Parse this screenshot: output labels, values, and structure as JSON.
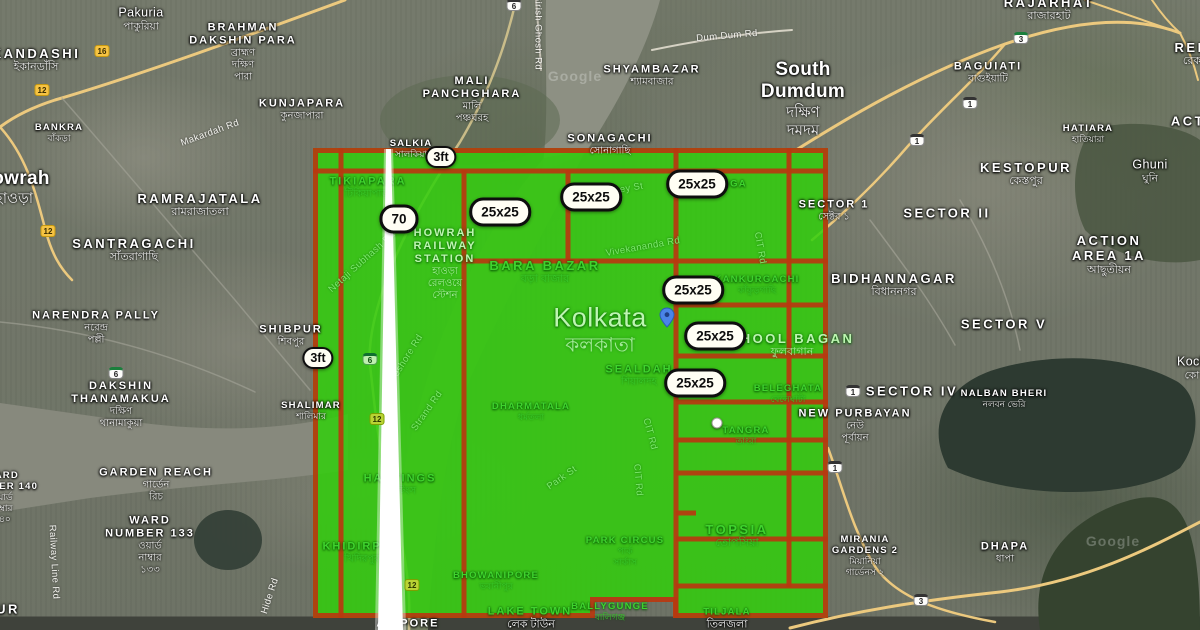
{
  "colors": {
    "overlay_green": "#31cf0c",
    "grid_red": "#b8380f",
    "badge_background": "#fffef4",
    "badge_border": "#0e0e0e",
    "pin_blue": "#4a84e8"
  },
  "overlay": {
    "badges": [
      {
        "t": "3ft",
        "x": 441,
        "y": 157,
        "small": true
      },
      {
        "t": "70",
        "x": 399,
        "y": 219,
        "small": false
      },
      {
        "t": "25x25",
        "x": 500,
        "y": 212,
        "small": false
      },
      {
        "t": "25x25",
        "x": 591,
        "y": 197,
        "small": false
      },
      {
        "t": "25x25",
        "x": 697,
        "y": 184,
        "small": false
      },
      {
        "t": "25x25",
        "x": 693,
        "y": 290,
        "small": false
      },
      {
        "t": "25x25",
        "x": 715,
        "y": 336,
        "small": false
      },
      {
        "t": "25x25",
        "x": 695,
        "y": 383,
        "small": false
      },
      {
        "t": "3ft",
        "x": 318,
        "y": 358,
        "small": true
      }
    ]
  },
  "markers": {
    "pin": {
      "x": 667,
      "y": 317
    },
    "dot": {
      "x": 717,
      "y": 423
    }
  },
  "place_labels": [
    {
      "t": "Pakuria",
      "bn": "পাকুরিয়া",
      "x": 141,
      "y": 19,
      "cls": "town",
      "tint": "w"
    },
    {
      "t": "BRAHMAN\nDAKSHIN PARA",
      "bn": "ব্রাহ্মণ\nদক্ষিণ\nপারা",
      "x": 243,
      "y": 52,
      "cls": "area",
      "tint": "w"
    },
    {
      "t": "KANDASHI",
      "bn": "ইকানডাঁসি",
      "x": 36,
      "y": 60,
      "cls": "area-lg",
      "tint": "w"
    },
    {
      "t": "KUNJAPARA",
      "bn": "কুনজাপারা",
      "x": 302,
      "y": 110,
      "cls": "area",
      "tint": "w"
    },
    {
      "t": "BANKRA",
      "bn": "বাঁকড়া",
      "x": 59,
      "y": 133,
      "cls": "area-sm",
      "tint": "w"
    },
    {
      "t": "Howrah",
      "bn": "হাওড়া",
      "x": 14,
      "y": 188,
      "cls": "city",
      "tint": "w"
    },
    {
      "t": "RAMRAJATALA",
      "bn": "রামরাজাতলা",
      "x": 200,
      "y": 205,
      "cls": "area-lg",
      "tint": "w"
    },
    {
      "t": "SANTRAGACHI",
      "bn": "সাঁতরাগাছি",
      "x": 134,
      "y": 250,
      "cls": "area-lg",
      "tint": "w"
    },
    {
      "t": "NARENDRA PALLY",
      "bn": "নরেন্দ্র\nপল্লী",
      "x": 96,
      "y": 328,
      "cls": "area",
      "tint": "w"
    },
    {
      "t": "SHIBPUR",
      "bn": "শিবপুর",
      "x": 291,
      "y": 336,
      "cls": "area",
      "tint": "w"
    },
    {
      "t": "DAKSHIN\nTHANAMAKUA",
      "bn": "দক্ষিণ\nথানামাকুয়া",
      "x": 121,
      "y": 405,
      "cls": "area",
      "tint": "w"
    },
    {
      "t": "SHALIMAR",
      "bn": "শালিমার",
      "x": 311,
      "y": 411,
      "cls": "area-sm",
      "tint": "w"
    },
    {
      "t": "GARDEN REACH",
      "bn": "গার্ডেন\nরিচ",
      "x": 156,
      "y": 485,
      "cls": "area",
      "tint": "w"
    },
    {
      "t": "WARD\nNUMBER 140",
      "bn": "ওয়ার্ড\nনাম্বার\n১৪০",
      "x": 2,
      "y": 497,
      "cls": "area-sm",
      "tint": "w"
    },
    {
      "t": "WARD\nNUMBER 133",
      "bn": "ওয়ার্ড\nনাম্বার\n১৩৩",
      "x": 150,
      "y": 545,
      "cls": "area",
      "tint": "w"
    },
    {
      "t": "UR",
      "x": 8,
      "y": 609,
      "cls": "area-lg",
      "tint": "w"
    },
    {
      "t": "MALI\nPANCHGHARA",
      "bn": "মালি\nপঞ্চঘরহ",
      "x": 472,
      "y": 100,
      "cls": "area",
      "tint": "w"
    },
    {
      "t": "SHYAMBAZAR",
      "bn": "শ্যামবাজার",
      "x": 652,
      "y": 76,
      "cls": "area",
      "tint": "w"
    },
    {
      "t": "South\nDumdum",
      "bn": "দক্ষিণ\nদমদম",
      "x": 803,
      "y": 99,
      "cls": "city",
      "tint": "w"
    },
    {
      "t": "SONAGACHI",
      "bn": "সোনাগাছি",
      "x": 610,
      "y": 145,
      "cls": "area",
      "tint": "w"
    },
    {
      "t": "SALKIA",
      "bn": "সালকিয়া",
      "x": 411,
      "y": 149,
      "cls": "area-sm",
      "tint": "w"
    },
    {
      "t": "RAJARHAT",
      "bn": "রাজারহাট",
      "x": 1049,
      "y": 9,
      "cls": "area-lg",
      "tint": "w"
    },
    {
      "t": "BAGUIATI",
      "bn": "বাগুইয়াটি",
      "x": 988,
      "y": 73,
      "cls": "area",
      "tint": "w"
    },
    {
      "t": "KESTOPUR",
      "bn": "কেস্তপুর",
      "x": 1026,
      "y": 174,
      "cls": "area-lg",
      "tint": "w"
    },
    {
      "t": "HATIARA",
      "bn": "হাতিয়ারা",
      "x": 1088,
      "y": 134,
      "cls": "area-sm",
      "tint": "w"
    },
    {
      "t": "Ghuni",
      "bn": "ঘুনি",
      "x": 1150,
      "y": 171,
      "cls": "town",
      "tint": "w"
    },
    {
      "t": "REK",
      "bn": "রেক",
      "x": 1192,
      "y": 54,
      "cls": "area-lg",
      "tint": "w"
    },
    {
      "t": "ACT",
      "x": 1188,
      "y": 121,
      "cls": "area-lg",
      "tint": "w"
    },
    {
      "t": "SECTOR 1",
      "bn": "সেক্টর ১",
      "x": 834,
      "y": 211,
      "cls": "area",
      "tint": "w"
    },
    {
      "t": "SECTOR II",
      "x": 947,
      "y": 213,
      "cls": "area-lg",
      "tint": "w"
    },
    {
      "t": "ACTION\nAREA 1A",
      "bn": "আছুতীয়ন",
      "x": 1109,
      "y": 255,
      "cls": "area-lg",
      "tint": "w"
    },
    {
      "t": "BIDHANNAGAR",
      "bn": "বিধাননগর",
      "x": 894,
      "y": 285,
      "cls": "area-lg",
      "tint": "w"
    },
    {
      "t": "SECTOR V",
      "x": 1004,
      "y": 324,
      "cls": "area-lg",
      "tint": "w"
    },
    {
      "t": "SECTOR IV",
      "x": 912,
      "y": 391,
      "cls": "area-lg",
      "tint": "w"
    },
    {
      "t": "NALBAN BHERI",
      "bn": "নলবন ভেরি",
      "x": 1004,
      "y": 399,
      "cls": "area-sm",
      "tint": "w"
    },
    {
      "t": "NEW PURBAYAN",
      "bn": "নেউ\nপূর্বায়ন",
      "x": 855,
      "y": 426,
      "cls": "area",
      "tint": "w"
    },
    {
      "t": "Koch",
      "bn": "কো",
      "x": 1192,
      "y": 368,
      "cls": "town",
      "tint": "w"
    },
    {
      "t": "MIRANIA\nGARDENS 2",
      "bn": "মিয়ানিয়া\nগার্ডেনস ২",
      "x": 865,
      "y": 556,
      "cls": "area-sm",
      "tint": "w"
    },
    {
      "t": "DHAPA",
      "bn": "ধাপা",
      "x": 1005,
      "y": 553,
      "cls": "area",
      "tint": "w"
    },
    {
      "t": "ALIPORE",
      "x": 408,
      "y": 624,
      "cls": "area",
      "tint": "w"
    },
    {
      "t": "লেক টাউন",
      "x": 531,
      "y": 625,
      "cls": "bn-only",
      "tint": "w"
    },
    {
      "t": "তিলজলা",
      "x": 727,
      "y": 625,
      "cls": "bn-only",
      "tint": "w"
    },
    {
      "t": "TIKIAPARA",
      "bn": "টিকিয়াপাড়া",
      "x": 368,
      "y": 188,
      "cls": "area",
      "tint": "g"
    },
    {
      "t": "HOWRAH\nRAILWAY\nSTATION",
      "bn": "হাওড়া\nরেলওয়ে\nস্টেশন",
      "x": 445,
      "y": 264,
      "cls": "area",
      "tint": "gb"
    },
    {
      "t": "BARA BAZAR",
      "bn": "বড়া বাজার",
      "x": 545,
      "y": 272,
      "cls": "area-lg",
      "tint": "g"
    },
    {
      "t": "Kolkata",
      "bn": "কলকাতা",
      "x": 600,
      "y": 330,
      "cls": "city-xl",
      "tint": "gb"
    },
    {
      "t": "KANKURGACHI",
      "bn": "কাঁকুড়গাছি",
      "x": 757,
      "y": 285,
      "cls": "area-sm",
      "tint": "g"
    },
    {
      "t": "ULTADANGA",
      "x": 712,
      "y": 184,
      "cls": "area-sm",
      "tint": "g"
    },
    {
      "t": "PHOOL BAGAN",
      "bn": "ফুলবাগান",
      "x": 792,
      "y": 345,
      "cls": "area-lg",
      "tint": "gb"
    },
    {
      "t": "SEALDAH",
      "bn": "শিয়ালদহ",
      "x": 639,
      "y": 376,
      "cls": "area",
      "tint": "g"
    },
    {
      "t": "BELEGHATA",
      "bn": "বেলেঘাটা",
      "x": 788,
      "y": 394,
      "cls": "area-sm",
      "tint": "g"
    },
    {
      "t": "TANGRA",
      "bn": "তাংরা",
      "x": 746,
      "y": 436,
      "cls": "area-sm",
      "tint": "g"
    },
    {
      "t": "DHARMATALA",
      "bn": "ধর্মতলা",
      "x": 531,
      "y": 412,
      "cls": "area-sm",
      "tint": "g"
    },
    {
      "t": "HASTINGS",
      "bn": "হেস্টিংস",
      "x": 400,
      "y": 485,
      "cls": "area",
      "tint": "g"
    },
    {
      "t": "KHIDIRPUR",
      "bn": "খিদিরপুর",
      "x": 362,
      "y": 553,
      "cls": "area",
      "tint": "g"
    },
    {
      "t": "PARK CIRCUS",
      "bn": "পার্ক\nসার্কাস",
      "x": 625,
      "y": 551,
      "cls": "area-sm",
      "tint": "g"
    },
    {
      "t": "TOPSIA",
      "bn": "তোপসিয়া",
      "x": 737,
      "y": 536,
      "cls": "area-lg",
      "tint": "g"
    },
    {
      "t": "BHOWANIPORE",
      "bn": "ভবানীপুর",
      "x": 496,
      "y": 581,
      "cls": "area-sm",
      "tint": "g"
    },
    {
      "t": "BALLYGUNGE",
      "bn": "বালিগঞ্জ",
      "x": 610,
      "y": 612,
      "cls": "area-sm",
      "tint": "g"
    },
    {
      "t": "LAKE TOWN",
      "x": 530,
      "y": 612,
      "cls": "area",
      "tint": "g"
    },
    {
      "t": "TILJALA",
      "x": 727,
      "y": 612,
      "cls": "area-sm",
      "tint": "g"
    }
  ],
  "road_labels": [
    {
      "t": "Makardah Rd",
      "x": 210,
      "y": 133,
      "rot": -20,
      "tint": "w"
    },
    {
      "t": "Dum Dum Rd",
      "x": 727,
      "y": 36,
      "rot": -5,
      "tint": "w"
    },
    {
      "t": "Girish Ghosh Rd",
      "x": 538,
      "y": 32,
      "rot": 90,
      "tint": "w"
    },
    {
      "t": "Grey St",
      "x": 626,
      "y": 189,
      "rot": -10,
      "tint": "g"
    },
    {
      "t": "Vivekananda Rd",
      "x": 643,
      "y": 247,
      "rot": -10,
      "tint": "g"
    },
    {
      "t": "Netaji Subhash Rd",
      "x": 362,
      "y": 262,
      "rot": -42,
      "tint": "g"
    },
    {
      "t": "Foreshore Rd",
      "x": 404,
      "y": 362,
      "rot": -58,
      "tint": "g"
    },
    {
      "t": "Strand Rd",
      "x": 427,
      "y": 411,
      "rot": -55,
      "tint": "g"
    },
    {
      "t": "Park St",
      "x": 562,
      "y": 478,
      "rot": -35,
      "tint": "g"
    },
    {
      "t": "CIT Rd",
      "x": 760,
      "y": 248,
      "rot": 80,
      "tint": "g"
    },
    {
      "t": "CIT Rd",
      "x": 650,
      "y": 434,
      "rot": 75,
      "tint": "g"
    },
    {
      "t": "CIT Rd",
      "x": 638,
      "y": 480,
      "rot": 85,
      "tint": "g"
    },
    {
      "t": "Railway Line Rd",
      "x": 54,
      "y": 562,
      "rot": 87,
      "tint": "w"
    },
    {
      "t": "Hide Rd",
      "x": 270,
      "y": 596,
      "rot": -72,
      "tint": "w"
    }
  ],
  "shields": [
    {
      "n": "16",
      "x": 102,
      "y": 51,
      "kind": "yellow",
      "tint": false
    },
    {
      "n": "12",
      "x": 42,
      "y": 90,
      "kind": "yellow",
      "tint": false
    },
    {
      "n": "12",
      "x": 48,
      "y": 231,
      "kind": "yellow",
      "tint": false
    },
    {
      "n": "6",
      "x": 514,
      "y": 5,
      "kind": "nh",
      "tint": false
    },
    {
      "n": "6",
      "x": 116,
      "y": 373,
      "kind": "sh",
      "tint": false
    },
    {
      "n": "3",
      "x": 1021,
      "y": 38,
      "kind": "sh",
      "tint": false
    },
    {
      "n": "1",
      "x": 970,
      "y": 103,
      "kind": "nh",
      "tint": false
    },
    {
      "n": "1",
      "x": 917,
      "y": 140,
      "kind": "nh",
      "tint": false
    },
    {
      "n": "1",
      "x": 853,
      "y": 391,
      "kind": "nh",
      "tint": false
    },
    {
      "n": "1",
      "x": 835,
      "y": 467,
      "kind": "nh",
      "tint": false
    },
    {
      "n": "3",
      "x": 921,
      "y": 600,
      "kind": "nh",
      "tint": false
    },
    {
      "n": "6",
      "x": 370,
      "y": 359,
      "kind": "sh",
      "tint": true
    },
    {
      "n": "12",
      "x": 377,
      "y": 419,
      "kind": "yellow",
      "tint": true
    },
    {
      "n": "12",
      "x": 412,
      "y": 585,
      "kind": "yellow",
      "tint": true
    }
  ],
  "watermarks": [
    {
      "t": "Google",
      "x": 575,
      "y": 76
    },
    {
      "t": "Google",
      "x": 1113,
      "y": 541
    }
  ]
}
